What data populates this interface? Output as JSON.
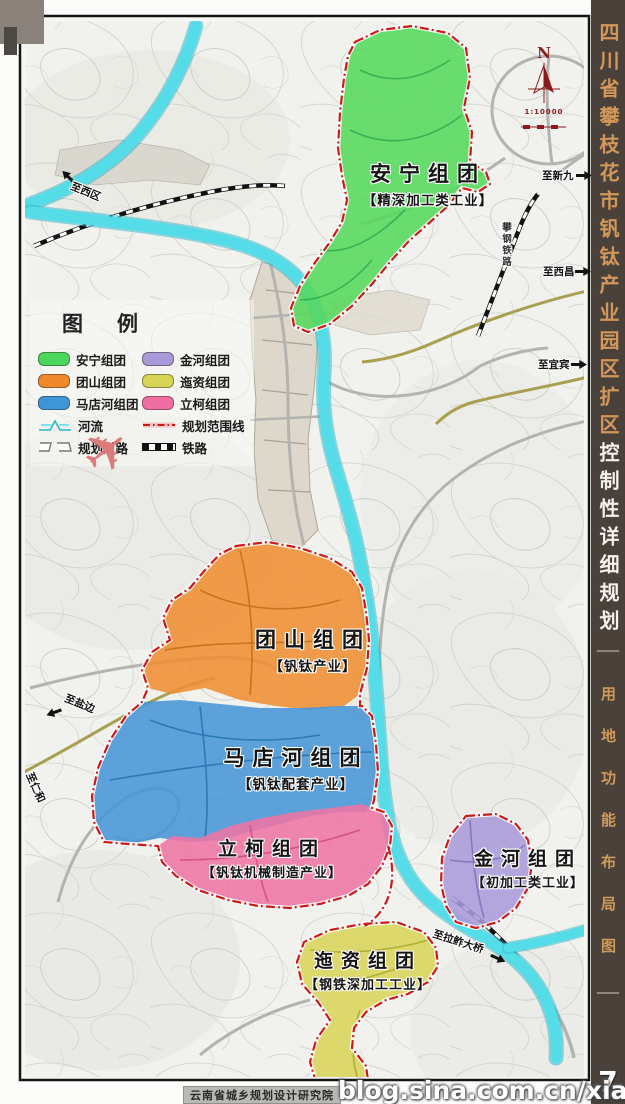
{
  "sidebar": {
    "title_orange": "四川省攀枝花市钒钛产业园区扩区",
    "title_white": "控制性详细规划",
    "subtitle": "用地功能布局图"
  },
  "footer": {
    "agency": "云南省城乡规划设计研究院",
    "watermark": "blog.sina.com.cn/xiagrui",
    "logo_text": "7"
  },
  "compass": {
    "north_label": "N",
    "scale_text": "1:10000"
  },
  "legend": {
    "title": "图例",
    "left": [
      {
        "label": "安宁组团",
        "color": "#4cd75c"
      },
      {
        "label": "团山组团",
        "color": "#f0882c"
      },
      {
        "label": "马店河组团",
        "color": "#3e96d8"
      },
      {
        "label": "河流"
      },
      {
        "label": "规划道路"
      }
    ],
    "right": [
      {
        "label": "金河组团",
        "color": "#a89ad8"
      },
      {
        "label": "迤资组团",
        "color": "#d8d455"
      },
      {
        "label": "立柯组团",
        "color": "#f06ea2"
      },
      {
        "label": "规划范围线",
        "color": "#cc1616"
      },
      {
        "label": "铁路",
        "color": "#111111"
      }
    ]
  },
  "zones": [
    {
      "name": "安宁组团",
      "industry": "【精深加工类工业】",
      "color": "#55d85c"
    },
    {
      "name": "团山组团",
      "industry": "【钒钛产业】",
      "color": "#ee8e33"
    },
    {
      "name": "马店河组团",
      "industry": "【钒钛配套产业】",
      "color": "#4795d6"
    },
    {
      "name": "立柯组团",
      "industry": "【钒钛机械制造产业】",
      "color": "#ee74a4"
    },
    {
      "name": "金河组团",
      "industry": "【初加工类工业】",
      "color": "#a99bda"
    },
    {
      "name": "迤资组团",
      "industry": "【钢铁深加工工业】",
      "color": "#d8d45a"
    }
  ],
  "directions": [
    {
      "text": "至西区"
    },
    {
      "text": "至新九"
    },
    {
      "text": "至西昌"
    },
    {
      "text": "至宜宾"
    },
    {
      "text": "至盐边"
    },
    {
      "text": "至仁和"
    },
    {
      "text": "至拉鲊大桥"
    },
    {
      "text": "攀钢铁路"
    }
  ],
  "colors": {
    "river": "#54dce8",
    "boundary_line": "#cf1818",
    "sidebar_bg": "#4a413b",
    "sidebar_orange_text": "#d2975a",
    "compass_red": "#8b1a1a"
  }
}
